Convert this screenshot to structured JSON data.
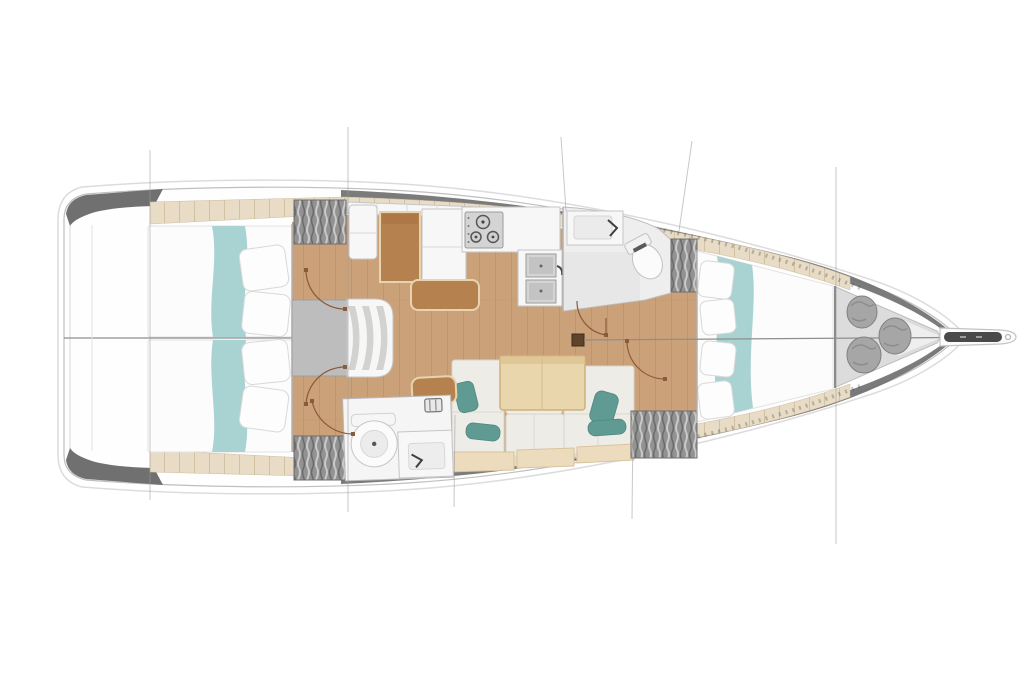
{
  "scene": {
    "subject": "sailing-yacht-interior-floor-plan",
    "view": "top-down",
    "bow_direction": "right"
  },
  "colors": {
    "background": "#ffffff",
    "hull_shell": "#dcdcdc",
    "hull_line": "#bfbfbf",
    "bulwark_gray": "#707070",
    "deck_beige": "#e8dcc6",
    "deck_plank": "#d2c2a2",
    "floor_wood": "#cba179",
    "floor_plank": "#b98e63",
    "bedding_white": "#fcfcfc",
    "bed_runner_teal": "#a9d2d2",
    "settee_cream": "#edece6",
    "settee_base_beige": "#ecdcbd",
    "cushion_teal": "#609b93",
    "table_wood": "#ead6ac",
    "desk_brown": "#b5824f",
    "desk_trim": "#e7d4ae",
    "locker_gray": "#929292",
    "hatch_light": "#c9c9c9",
    "hatch_dark": "#6a6a6a",
    "fixture_white": "#f7f7f7",
    "fixture_line": "#c6c6c6",
    "steel_gray": "#d4d4d4",
    "platform_gray": "#bdbdbd",
    "bag_gray": "#a6a6a6",
    "door_arc_brown": "#8a5a3a",
    "centerline_gray": "#8e8e8e",
    "section_line_gray": "#9c9c9c",
    "anchor_dark": "#4a4a4a",
    "mast_brown": "#5f432a"
  },
  "counts": {
    "aft_double_berths": 2,
    "forward_berths": 1,
    "heads_compartments": 2,
    "toilets": 2,
    "bathroom_sinks": 2,
    "galley_sink_basins": 2,
    "stove_burners": 3,
    "companionway_steps": 3,
    "hanging_lockers": 4,
    "sail_locker_bags": 3,
    "saloon_accent_cushions": 4,
    "aft_berth_pillows": 4,
    "forward_berth_pillows": 4,
    "door_swings": 5,
    "section_lines": 7
  }
}
